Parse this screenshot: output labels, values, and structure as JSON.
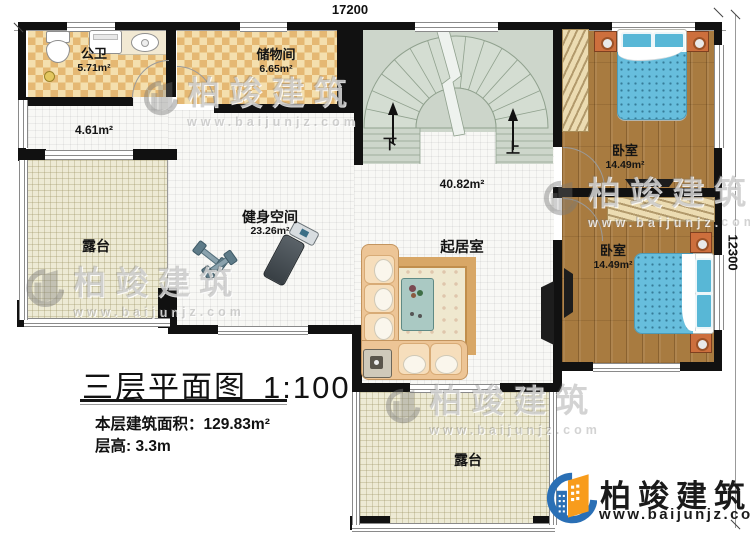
{
  "dimensions": {
    "top": "17200",
    "right": "12300"
  },
  "rooms": {
    "bathroom": {
      "name": "公卫",
      "area": "5.71m²"
    },
    "storage": {
      "name": "储物间",
      "area": "6.65m²"
    },
    "hallway": {
      "area": "4.61m²"
    },
    "gym": {
      "name": "健身空间",
      "area": "23.26m²"
    },
    "living": {
      "name": "起居室",
      "area": "40.82m²"
    },
    "bedroom1": {
      "name": "卧室",
      "area": "14.49m²"
    },
    "bedroom2": {
      "name": "卧室",
      "area": "14.49m²"
    },
    "terrace_left": {
      "name": "露台"
    },
    "terrace_bottom": {
      "name": "露台"
    }
  },
  "stairs": {
    "down_label": "下",
    "up_label": "上"
  },
  "title_block": {
    "title": "三层平面图",
    "scale": "1:100",
    "area_line": "本层建筑面积：129.83m²",
    "height_line": "层高: 3.3m"
  },
  "brand": {
    "name": "柏竣建筑",
    "url": "www.baijunjz.com"
  },
  "watermark": {
    "name": "柏竣建筑",
    "url": "www.baijunjz.com"
  },
  "colors": {
    "wall": "#111111",
    "checker_dark": "#e5b873",
    "wood": "#a87b40",
    "stair": "#cdd6cb",
    "terrace": "#edead4",
    "bed_blue": "#67bedd",
    "brand_blue": "#2a6fb5",
    "brand_orange": "#f89c1c"
  }
}
